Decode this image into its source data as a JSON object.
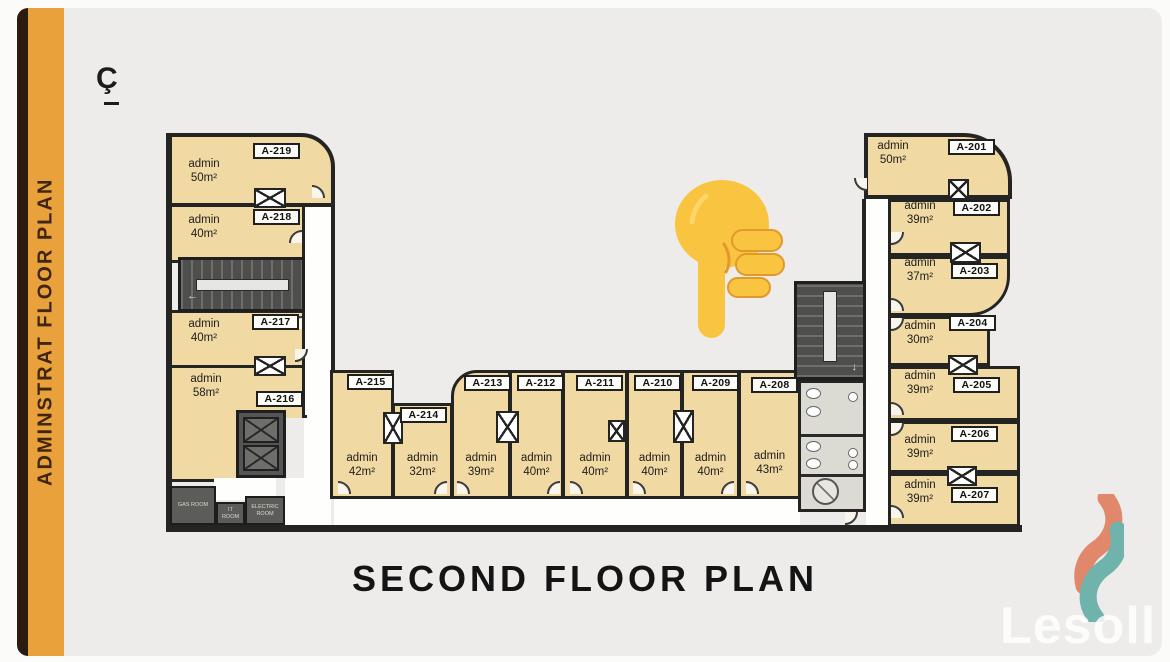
{
  "banner": {
    "text": "ADMINSTRAT FLOOR PLAN"
  },
  "north_mark": "Ç",
  "title": "SECOND FLOOR PLAN",
  "watermark": {
    "text": "Lesoll"
  },
  "emoji": {
    "name": "backhand-index-pointing-down"
  },
  "colors": {
    "banner_orange": "#E9A23B",
    "banner_edge": "#2B1D0E",
    "background": "#EDECEA",
    "room_fill": "#F0D9A2",
    "wall": "#242422",
    "stairs": "#4E4E4C",
    "utility": "#5C5C59",
    "bath": "#DBDAD3",
    "logo_salmon": "#E0876C",
    "logo_teal": "#6FB3AC",
    "emoji_yellow": "#F9C440"
  },
  "rooms": {
    "left": [
      {
        "id": "A-219",
        "type": "admin",
        "area": "50m²"
      },
      {
        "id": "A-218",
        "type": "admin",
        "area": "40m²"
      },
      {
        "id": "A-217",
        "type": "admin",
        "area": "40m²"
      },
      {
        "id": "A-216",
        "type": "admin",
        "area": "58m²"
      }
    ],
    "bottom": [
      {
        "id": "A-215",
        "type": "admin",
        "area": "42m²"
      },
      {
        "id": "A-214",
        "type": "admin",
        "area": "32m²"
      },
      {
        "id": "A-213",
        "type": "admin",
        "area": "39m²"
      },
      {
        "id": "A-212",
        "type": "admin",
        "area": "40m²"
      },
      {
        "id": "A-211",
        "type": "admin",
        "area": "40m²"
      },
      {
        "id": "A-210",
        "type": "admin",
        "area": "40m²"
      },
      {
        "id": "A-209",
        "type": "admin",
        "area": "40m²"
      },
      {
        "id": "A-208",
        "type": "admin",
        "area": "43m²"
      }
    ],
    "right": [
      {
        "id": "A-201",
        "type": "admin",
        "area": "50m²"
      },
      {
        "id": "A-202",
        "type": "admin",
        "area": "39m²"
      },
      {
        "id": "A-203",
        "type": "admin",
        "area": "37m²"
      },
      {
        "id": "A-204",
        "type": "admin",
        "area": "30m²"
      },
      {
        "id": "A-205",
        "type": "admin",
        "area": "39m²"
      },
      {
        "id": "A-206",
        "type": "admin",
        "area": "39m²"
      },
      {
        "id": "A-207",
        "type": "admin",
        "area": "39m²"
      }
    ]
  },
  "utility_rooms": [
    "GAS ROOM",
    "IT ROOM",
    "ELECTRIC ROOM"
  ]
}
